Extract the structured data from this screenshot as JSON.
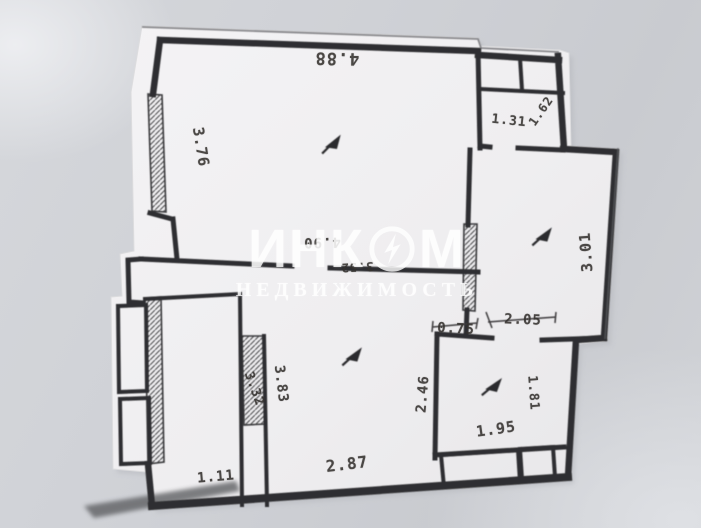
{
  "photo": {
    "type": "scanned floor plan with watermark",
    "colors": {
      "background": "#ced0d5",
      "paper": "#f1f0f2",
      "ink": "#2f2f30",
      "watermark": "#ffffff"
    }
  },
  "watermark": {
    "title_part1": "ИНК",
    "title_part2": "М",
    "subtitle": "НЕДВИЖИМОСТЬ",
    "logo_icon": "lightning-circle-icon"
  },
  "floorplan": {
    "dims": {
      "top_width": "4.88",
      "left_height": "3.76",
      "wc_width": "1.31",
      "wc_note": "1.62",
      "right_room_height": "3.01",
      "room_inner_width": "4.90",
      "hall_width": "3.52",
      "passage_width": "0.75",
      "kitchen_top_width": "2.05",
      "kitchen_left_height": "2.46",
      "kitchen_right_height": "1.81",
      "kitchen_bottom_width": "1.95",
      "partition_length": "3.83",
      "corridor_length": "3.32",
      "hall_bottom_width": "2.87",
      "narrow_room_width": "1.11"
    },
    "icons": {
      "room_pointers": "arrow-pointer-icon",
      "room_pointer_count": 4
    }
  }
}
